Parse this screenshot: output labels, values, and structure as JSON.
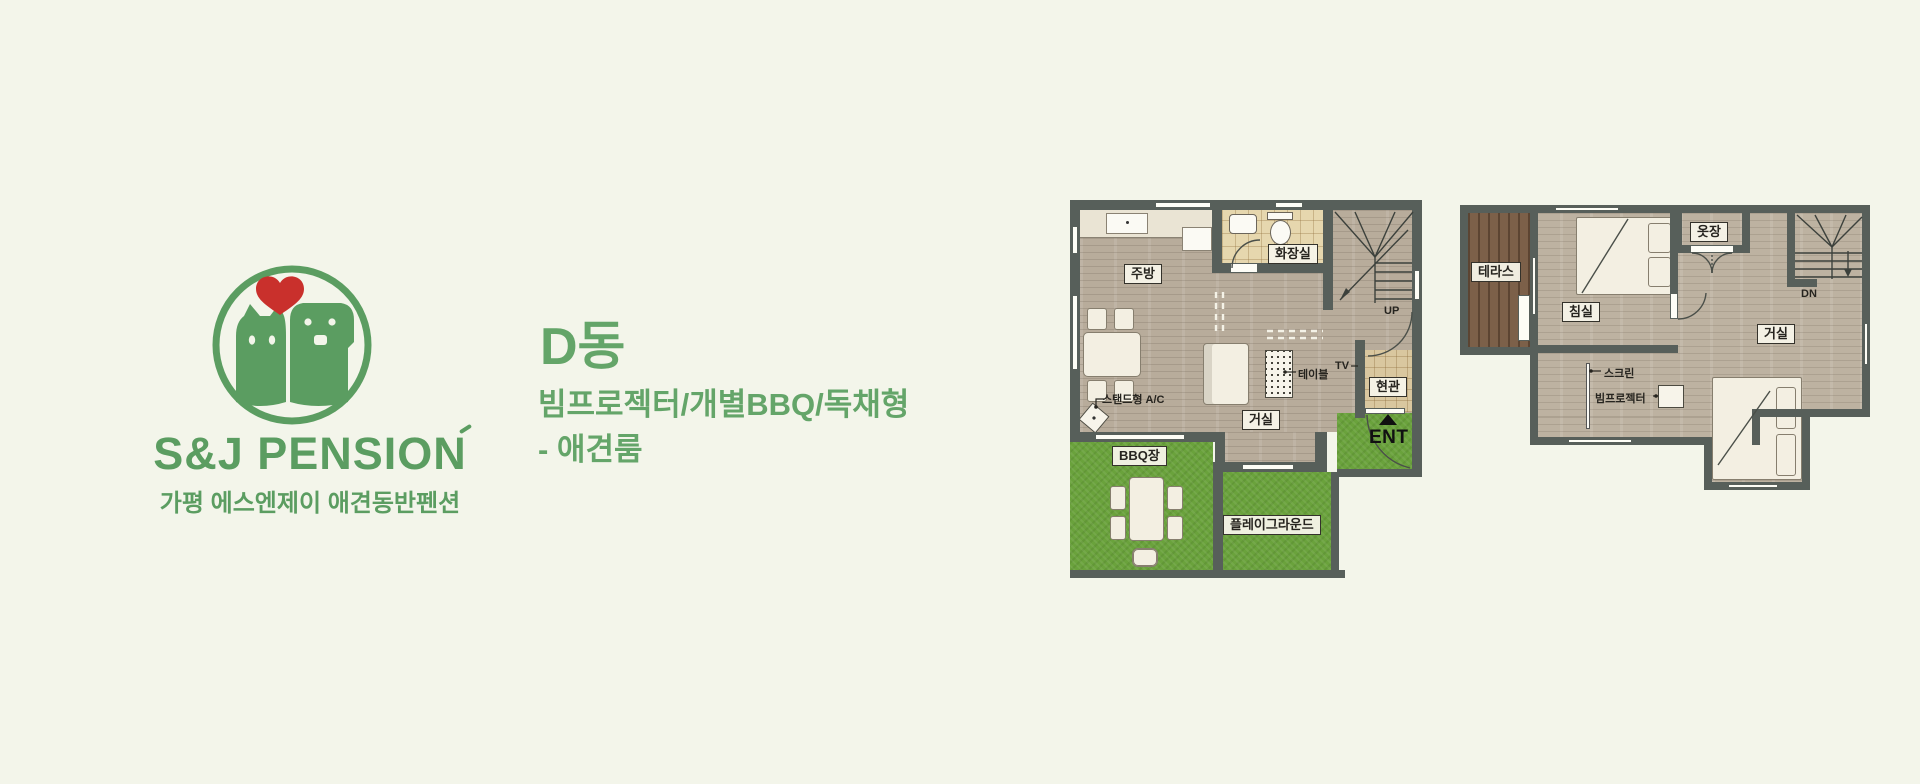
{
  "logo": {
    "brand": "S&J PENSION",
    "subtitle": "가평 에스엔제이 애견동반펜션",
    "green": "#5b9d61",
    "heart_red": "#c9302c"
  },
  "heading": {
    "title": "D동",
    "desc_line1": "빔프로젝터/개별BBQ/독채형",
    "desc_line2": "- 애견룸"
  },
  "floor1": {
    "labels": {
      "kitchen": "주방",
      "bathroom": "화장실",
      "living": "거실",
      "entrance": "현관",
      "bbq": "BBQ장",
      "playground": "플레이그라운드",
      "ac": "스탠드형 A/C",
      "tv": "TV",
      "table": "테이블",
      "up": "UP",
      "ent": "ENT"
    }
  },
  "floor2": {
    "labels": {
      "terrace": "테라스",
      "bedroom": "침실",
      "closet": "옷장",
      "living": "거실",
      "screen": "스크린",
      "projector": "빔프로젝터",
      "dn": "DN"
    }
  },
  "palette": {
    "background": "#f3f5ea",
    "wall": "#575f5a",
    "wood_floor": "#b8ac9b",
    "grass": "#6aa23c",
    "terrace_deck": "#7c6049",
    "bath_tile": "#e6d7ae",
    "entry_tile": "#d9c79f"
  }
}
